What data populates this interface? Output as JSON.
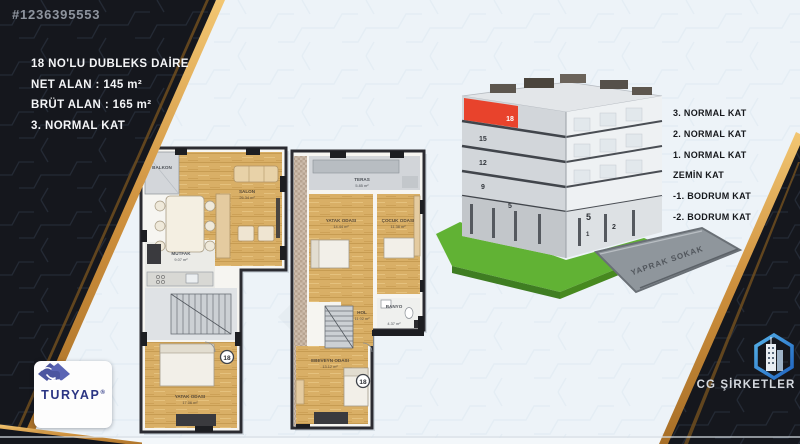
{
  "listing": {
    "id": "#1236395553",
    "title": "18 NO'LU DUBLEKS DAİRE",
    "net_area": "NET ALAN : 145 m²",
    "gross_area": "BRÜT ALAN : 165 m²",
    "floor": "3. NORMAL KAT"
  },
  "floor_labels": [
    "3. NORMAL KAT",
    "2. NORMAL KAT",
    "1. NORMAL KAT",
    "ZEMİN KAT",
    "-1. BODRUM KAT",
    "-2. BODRUM KAT"
  ],
  "building": {
    "highlight_number": "18",
    "left_numbers": [
      "15",
      "12",
      "9",
      "5"
    ],
    "right_numbers": [
      "5",
      "2",
      "1"
    ],
    "street": "YAPRAK SOKAK",
    "highlight_color": "#e8432c"
  },
  "plans": {
    "left": {
      "badge": "18",
      "balcony": "BALKON",
      "salon": "SALON",
      "salon_area": "26.34 m²",
      "kitchen": "MUTFAK",
      "kitchen_area": "9.07 m²",
      "bedroom": "YATAK ODASI",
      "bedroom_area": "17.06 m²"
    },
    "right": {
      "badge": "18",
      "terrace": "TERAS",
      "terrace_area": "5.85 m²",
      "bedroom1": "YATAK ODASI",
      "bedroom1_area": "14.44 m²",
      "bedroom2": "ÇOCUK ODASI",
      "bedroom2_area": "11.38 m²",
      "bath": "BANYO",
      "bath_area": "4.37 m²",
      "hall": "HOL",
      "hall_area": "11.02 m²",
      "master": "EBEVEYN ODASI",
      "master_area": "13.12 m²"
    }
  },
  "branding": {
    "agency": "TURYAP",
    "agency_mark": "®",
    "company": "CG ŞİRKETLER"
  },
  "watermark": ".com",
  "colors": {
    "gold": "#dda14c",
    "ribbon_black": "#15171d",
    "red": "#e8432c",
    "wood": "#d9af66",
    "grass": "#5fae33",
    "turyap_blue": "#4c55a0",
    "cg_blue": "#2e7cd6"
  }
}
